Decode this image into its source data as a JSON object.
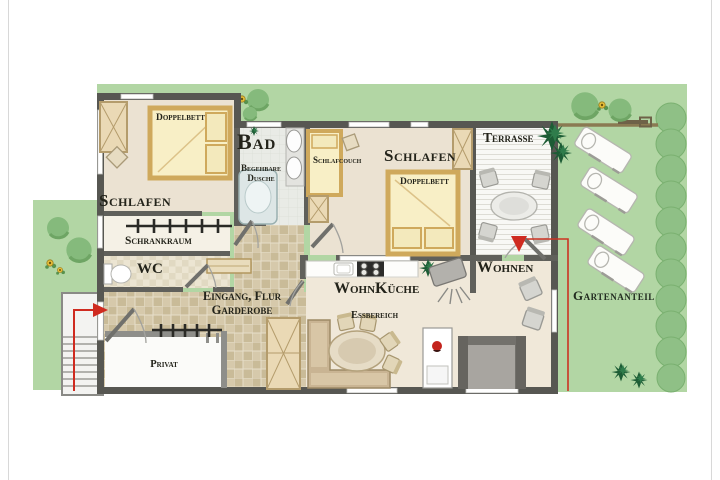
{
  "colors": {
    "garden_green": "#b2d6a4",
    "hedge_green": "#8fc086",
    "dark_plant_green": "#1d5c35",
    "wall_gray": "#575752",
    "floor_beige": "#ebe2d2",
    "tile_tan": "#d6c9ab",
    "bed_yellow": "#f8efc6",
    "bed_frame_tan": "#cfa95c",
    "accent_red": "#cf2b20"
  },
  "rooms": {
    "bedroom1": {
      "label": "Schlafen",
      "bed_label": "Doppelbett"
    },
    "wardrobe_room": {
      "label": "Schrankraum"
    },
    "wc": {
      "label": "WC"
    },
    "hallway": {
      "line1": "Eingang, Flur",
      "line2": "Garderobe"
    },
    "private_room": {
      "label": "Privat"
    },
    "bathroom": {
      "label": "Bad",
      "shower_line1": "Begehbare",
      "shower_line2": "Dusche"
    },
    "bedroom2": {
      "label": "Schlafen",
      "bed_label": "Doppelbett",
      "couch_label": "Schlafcouch"
    },
    "terrace": {
      "label": "Terrasse"
    },
    "kitchen": {
      "label": "WohnKüche",
      "dining_label": "Essbereich"
    },
    "living": {
      "label": "Wohnen"
    },
    "garden": {
      "label": "Gartenanteil"
    }
  }
}
